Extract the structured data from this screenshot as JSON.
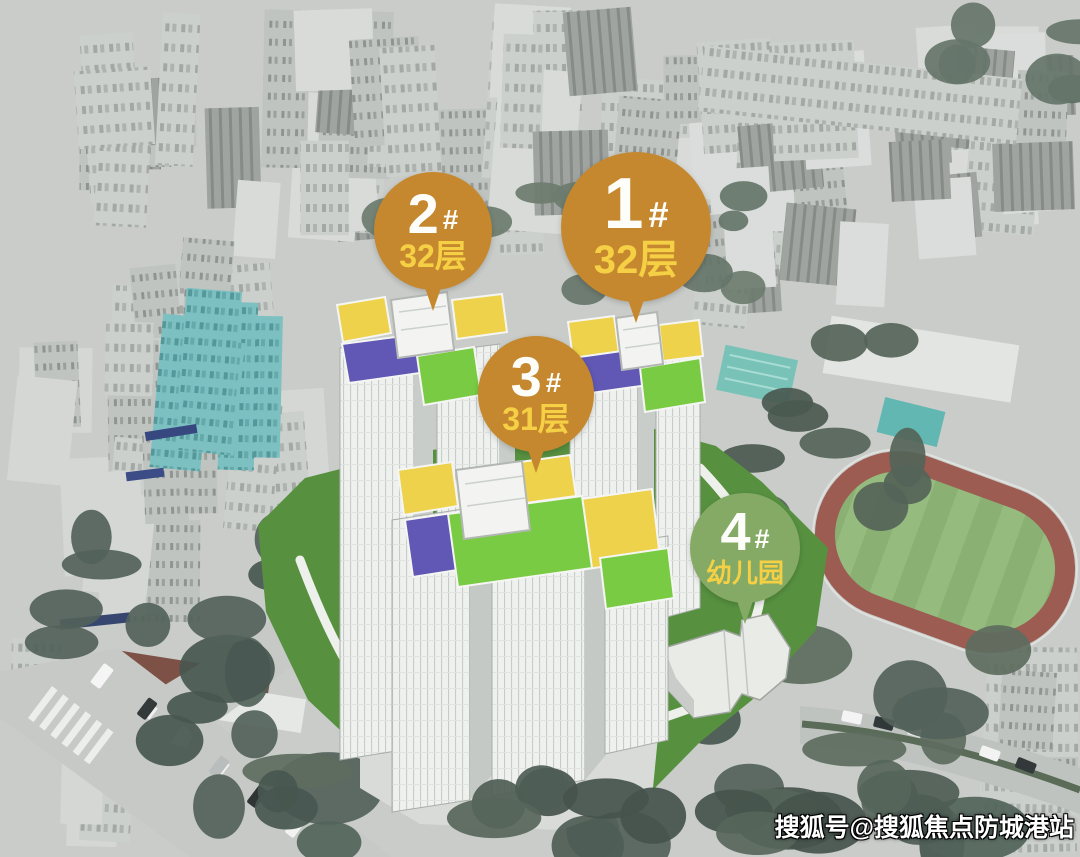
{
  "scene": {
    "description": "Aerial photo of a dense city with a 3D rendering of a residential development (4 labeled buildings) and a school sports field"
  },
  "markers": [
    {
      "number": "1",
      "hash": "#",
      "subtitle": "32层",
      "color": "#c5882f",
      "number_color": "#ffffff",
      "subtitle_color": "#f5d044"
    },
    {
      "number": "2",
      "hash": "#",
      "subtitle": "32层",
      "color": "#c5882f",
      "number_color": "#ffffff",
      "subtitle_color": "#f5d044"
    },
    {
      "number": "3",
      "hash": "#",
      "subtitle": "31层",
      "color": "#c5882f",
      "number_color": "#ffffff",
      "subtitle_color": "#f5d044"
    },
    {
      "number": "4",
      "hash": "#",
      "subtitle": "幼儿园",
      "color": "#85aa66",
      "number_color": "#ffffff",
      "subtitle_color": "#f5d044"
    }
  ],
  "watermark": {
    "text": "搜狐号@搜狐焦点防城港站"
  },
  "palette": {
    "marker_orange": "#c5882f",
    "marker_green": "#85aa66",
    "marker_subtitle_yellow": "#f5d044",
    "roof_yellow": "#eed24b",
    "roof_purple": "#6058b4",
    "roof_green": "#79cb43",
    "lawn_green": "#579140",
    "running_track_red": "#9c5c52",
    "sports_field_green": "#8ab173",
    "teal_building": "#7cc0c1",
    "city_gray": "#c9ccc9",
    "tree_green": "#53625a"
  }
}
